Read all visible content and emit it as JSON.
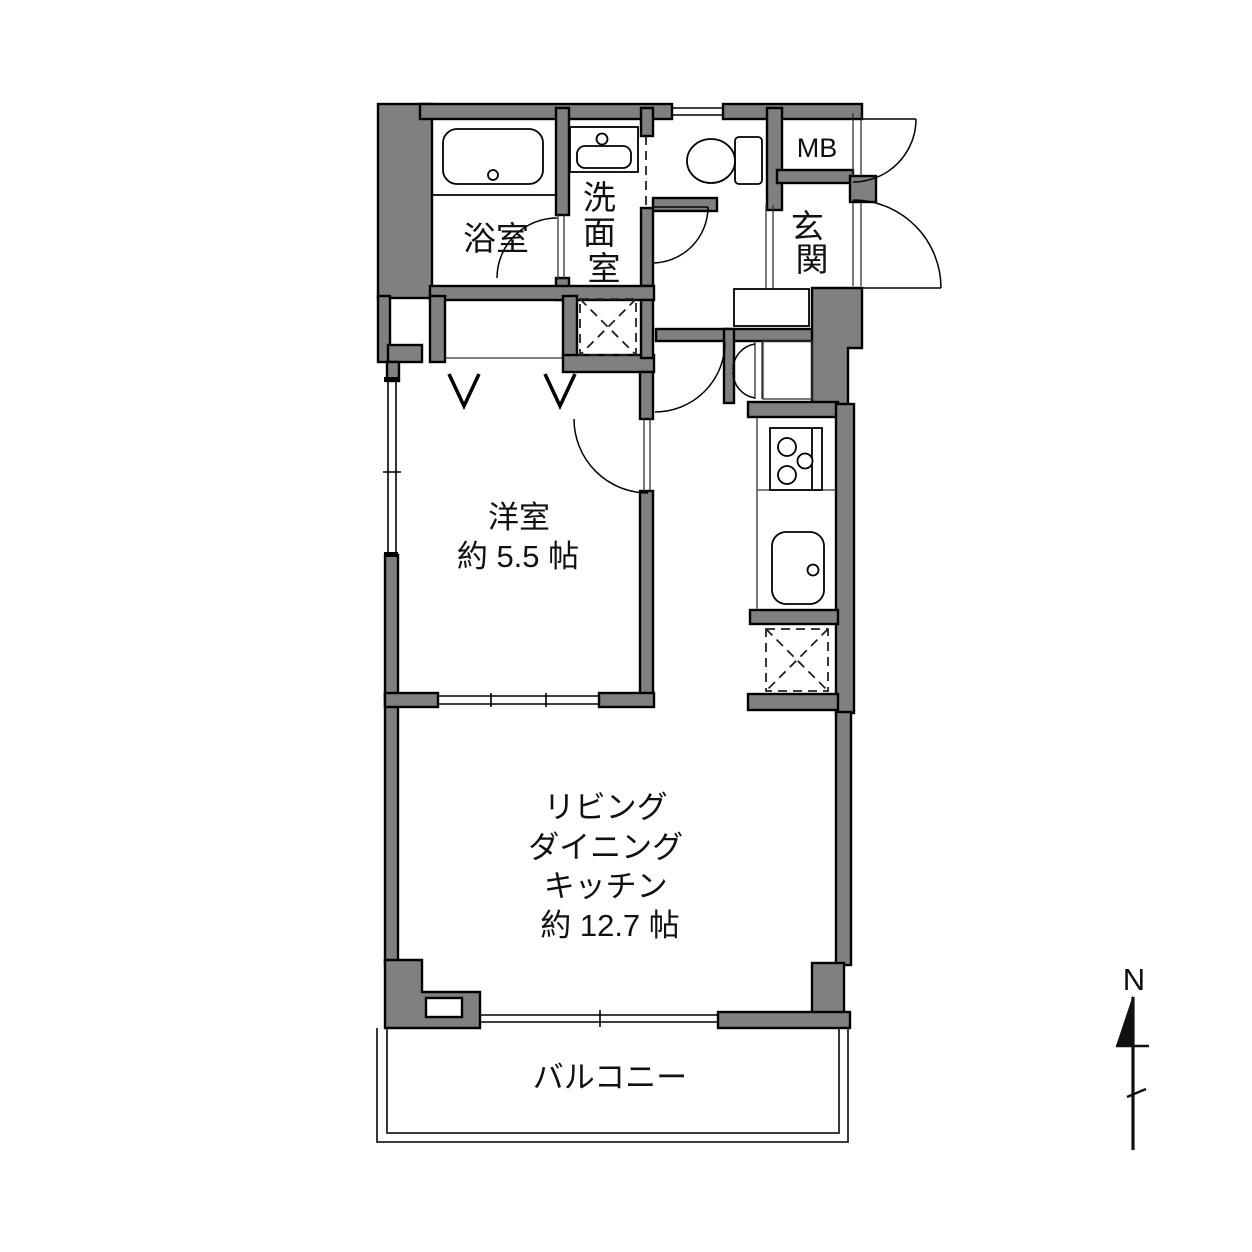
{
  "fp": {
    "title": "apartment-floor-plan",
    "rooms": {
      "bath": {
        "label": "浴室"
      },
      "washroom": {
        "label": "洗面室"
      },
      "meter_box": {
        "label": "MB"
      },
      "entrance": {
        "label": "玄関"
      },
      "western_room": {
        "label": "洋室",
        "size": "約 5.5 帖"
      },
      "ldk": {
        "lines": [
          "リビング",
          "ダイニング",
          "キッチン",
          "約 12.7 帖"
        ]
      },
      "balcony": {
        "label": "バルコニー"
      }
    },
    "compass": {
      "north_label": "N"
    },
    "icons": [
      "bathtub-icon",
      "washbasin-icon",
      "toilet-icon",
      "stove-icon",
      "kitchen-sink-icon",
      "washer-space-icon",
      "fridge-space-icon",
      "north-arrow-icon"
    ],
    "colors": {
      "wall_fill": "#808080",
      "line": "#000000",
      "bg": "#ffffff"
    }
  }
}
